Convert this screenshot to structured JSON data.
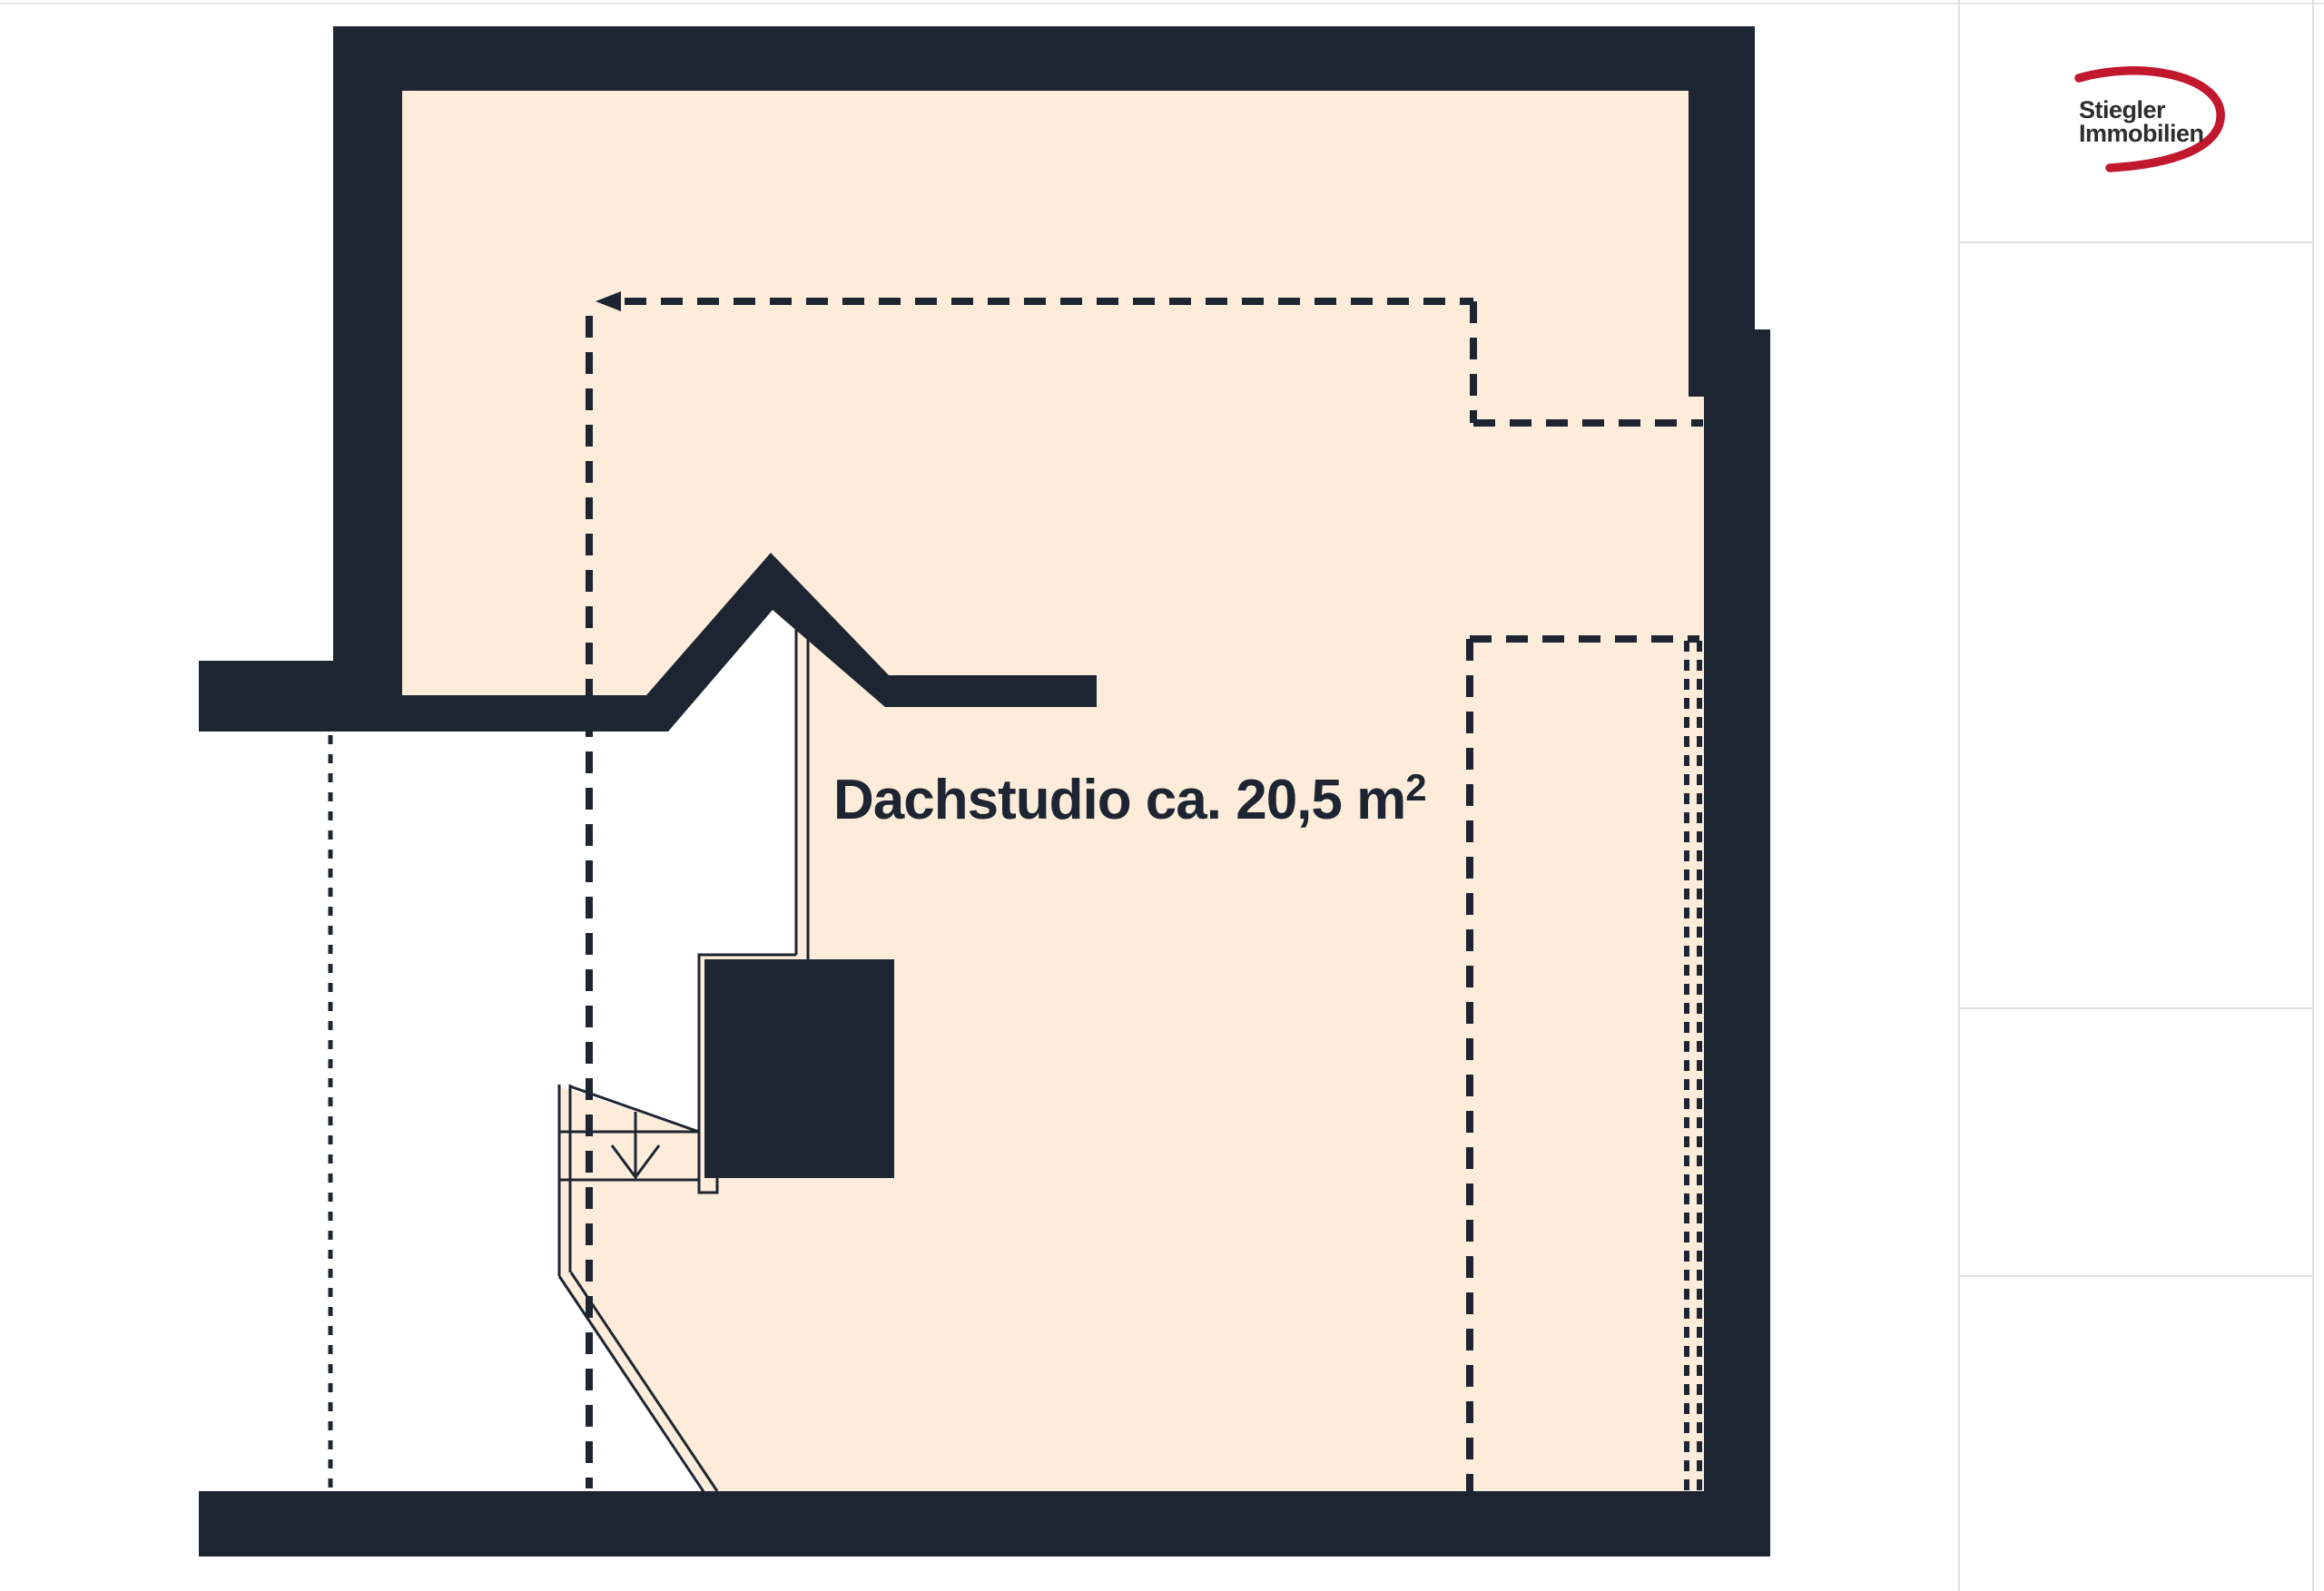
{
  "floorplan": {
    "label": {
      "main": "Dachstudio ca. 20,5 m",
      "sup": "2"
    },
    "colors": {
      "wall": "#1d2533",
      "floor": "#fcecd9",
      "void": "#ffffff",
      "line": "#1d2533"
    }
  },
  "brand": {
    "name_line1": "Stiegler",
    "name_line2": "Immobilien",
    "swoosh_color": "#c2182e",
    "text_color": "#2d2d2d"
  },
  "page": {
    "background": "#ffffff",
    "hairline": "#e1e1e1"
  }
}
